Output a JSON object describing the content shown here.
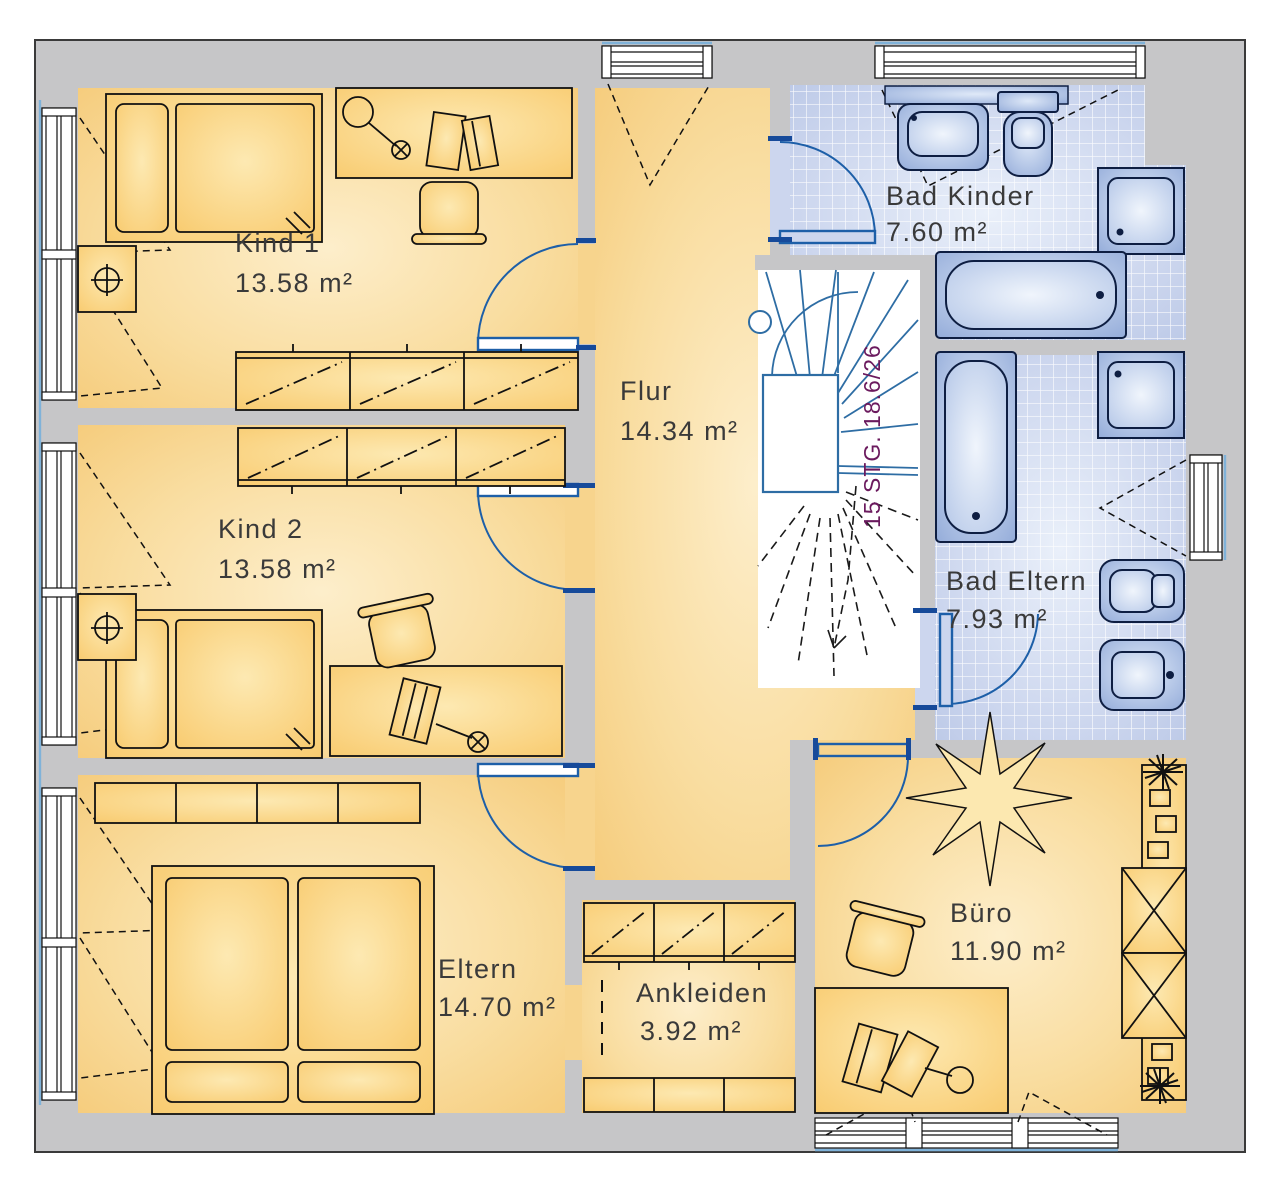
{
  "plan": {
    "type": "floor-plan",
    "rooms": [
      {
        "name": "Kind 1",
        "area": "13.58 m²"
      },
      {
        "name": "Kind 2",
        "area": "13.58 m²"
      },
      {
        "name": "Flur",
        "area": "14.34 m²"
      },
      {
        "name": "Bad Kinder",
        "area": "7.60 m²"
      },
      {
        "name": "Bad Eltern",
        "area": "7.93 m²"
      },
      {
        "name": "Eltern",
        "area": "14.70 m²"
      },
      {
        "name": "Ankleiden",
        "area": "3.92 m²"
      },
      {
        "name": "Büro",
        "area": "11.90 m²"
      }
    ],
    "stairs": {
      "label": "15 STG. 18.6/26"
    },
    "colors": {
      "wall_gray": "#c6c6c8",
      "floor_yellow": "#f6cc7c",
      "floor_yellow_light": "#fdeecb",
      "tile_blue": "#bcc9e7",
      "fixture_blue": "#8ba5d6",
      "door_blue": "#1d5fa8",
      "stair_tread_blue": "#2e6da4",
      "stair_text": "#6b1a5e",
      "glazing_blue": "#7fb2d9"
    }
  }
}
